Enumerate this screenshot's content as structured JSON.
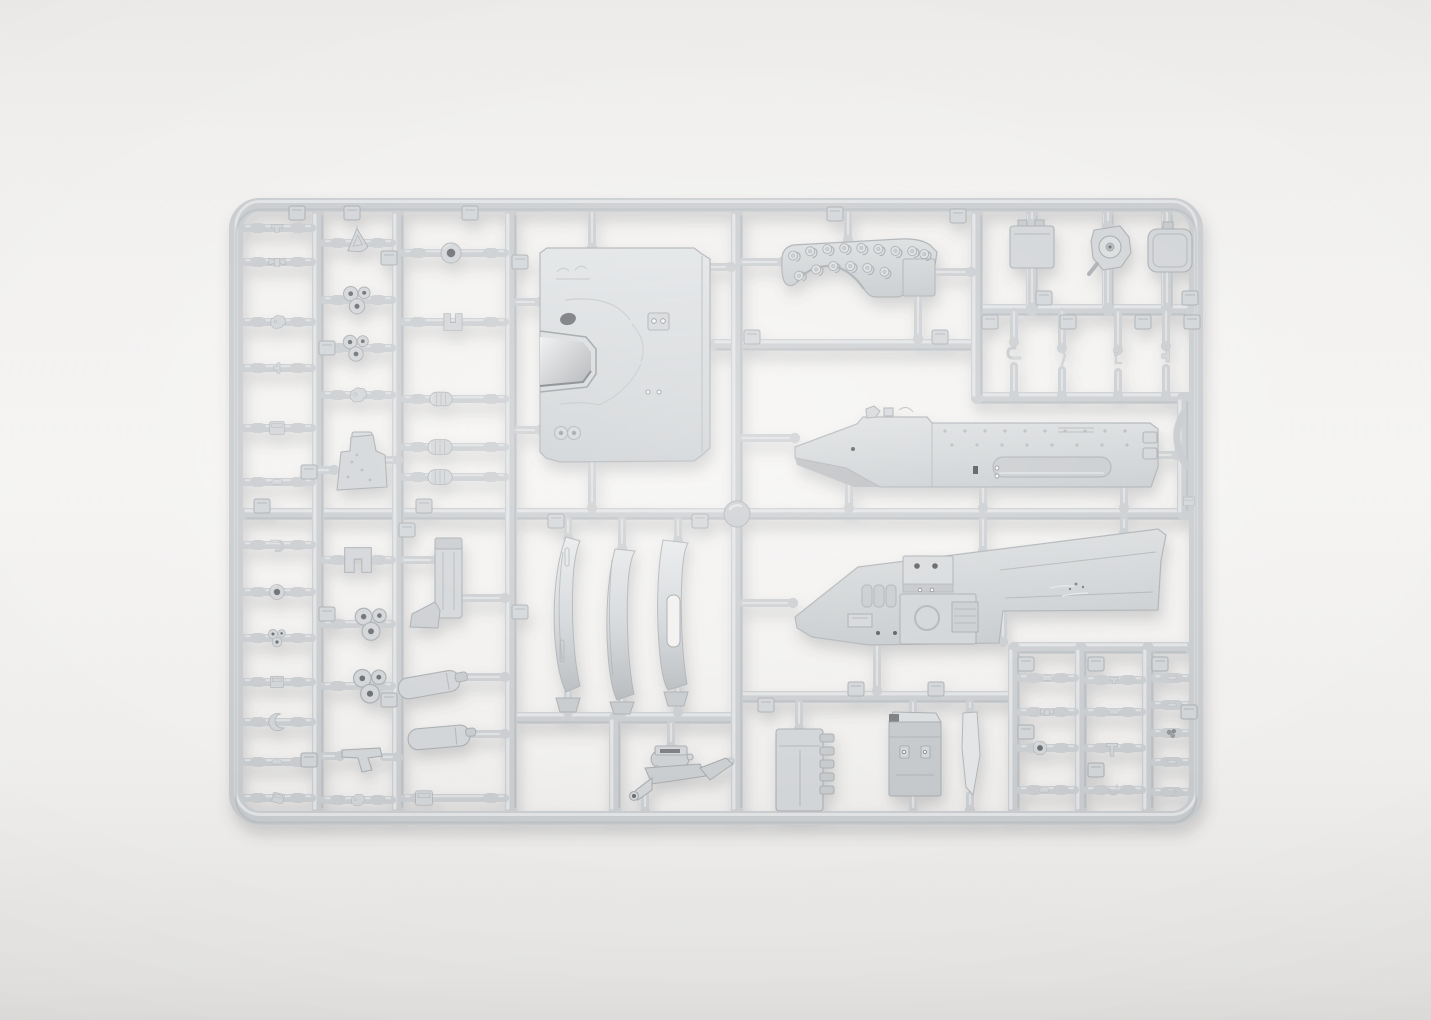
{
  "scene": {
    "description": "Photograph of a light gray injection-molded plastic model kit sprue (parts runner tree) for an armored vehicle kit, lying on a plain white studio background with a soft drop shadow",
    "object": "plastic model kit sprue",
    "material": "light gray styrene plastic",
    "background": "plain white-gray seamless backdrop",
    "colors": {
      "background_top": "#eceae8",
      "background_mid": "#f4f3f1",
      "background_bottom": "#dfdedc",
      "plastic_base": "#c5c8cb",
      "plastic_light": "#e0e2e4",
      "plastic_dark": "#a5a9ac",
      "part_fill": "#ced1d4",
      "part_stroke": "#a2a6a9",
      "panel_light": "#dee1e3",
      "panel_dark": "#c1c5c8",
      "hole_dark": "#5c5f63",
      "shadow": "#55555a"
    }
  },
  "sprue": {
    "frame": {
      "x1": 236,
      "y1": 205,
      "x2": 1196,
      "y2": 818,
      "radius": 24,
      "thickness": 14
    },
    "runners_vertical": [
      [
        318,
        212,
        811
      ],
      [
        398,
        212,
        811
      ],
      [
        511,
        212,
        811
      ],
      [
        737,
        212,
        811
      ],
      [
        977,
        212,
        398
      ],
      [
        615,
        718,
        811
      ],
      [
        1014,
        648,
        811
      ],
      [
        1081,
        648,
        811
      ],
      [
        1148,
        648,
        811
      ],
      [
        1032,
        212,
        310
      ],
      [
        1108,
        212,
        310
      ],
      [
        1167,
        212,
        310
      ],
      [
        1183,
        398,
        514
      ]
    ],
    "runners_horizontal": [
      [
        243,
        1189,
        514
      ],
      [
        713,
        977,
        345
      ],
      [
        977,
        1189,
        398
      ],
      [
        977,
        1189,
        310
      ],
      [
        511,
        737,
        718
      ],
      [
        737,
        1014,
        697
      ],
      [
        1014,
        1189,
        648
      ]
    ],
    "row_stems": [
      [
        228,
        244,
        312
      ],
      [
        262,
        244,
        312
      ],
      [
        322,
        244,
        312
      ],
      [
        368,
        244,
        312
      ],
      [
        428,
        244,
        312
      ],
      [
        482,
        244,
        312
      ],
      [
        545,
        244,
        312
      ],
      [
        592,
        244,
        312
      ],
      [
        638,
        244,
        312
      ],
      [
        682,
        244,
        312
      ],
      [
        722,
        244,
        312
      ],
      [
        762,
        244,
        312
      ],
      [
        798,
        244,
        312
      ],
      [
        243,
        324,
        392
      ],
      [
        300,
        324,
        392
      ],
      [
        348,
        324,
        392
      ],
      [
        395,
        324,
        392
      ],
      [
        560,
        324,
        392
      ],
      [
        624,
        324,
        392
      ],
      [
        686,
        324,
        392
      ],
      [
        800,
        324,
        392
      ],
      [
        253,
        404,
        505
      ],
      [
        322,
        404,
        505
      ],
      [
        399,
        404,
        505
      ],
      [
        447,
        404,
        505
      ],
      [
        477,
        404,
        505
      ],
      [
        798,
        404,
        505
      ],
      [
        678,
        1020,
        1075
      ],
      [
        712,
        1020,
        1075
      ],
      [
        748,
        1020,
        1075
      ],
      [
        790,
        1020,
        1075
      ],
      [
        680,
        1087,
        1142
      ],
      [
        712,
        1087,
        1142
      ],
      [
        748,
        1087,
        1142
      ],
      [
        790,
        1087,
        1142
      ],
      [
        678,
        1154,
        1189
      ],
      [
        705,
        1154,
        1189
      ],
      [
        733,
        1154,
        1189
      ],
      [
        762,
        1154,
        1189
      ],
      [
        792,
        1154,
        1189
      ]
    ],
    "stems": [
      [
        592,
        212,
        592,
        248
      ],
      [
        592,
        462,
        592,
        508
      ],
      [
        517,
        302,
        540,
        302
      ],
      [
        517,
        430,
        540,
        430
      ],
      [
        704,
        267,
        731,
        267
      ],
      [
        848,
        212,
        848,
        240
      ],
      [
        743,
        262,
        782,
        262
      ],
      [
        935,
        272,
        971,
        272
      ],
      [
        918,
        296,
        918,
        339
      ],
      [
        743,
        438,
        795,
        438
      ],
      [
        849,
        468,
        849,
        508
      ],
      [
        983,
        488,
        983,
        508
      ],
      [
        1124,
        486,
        1124,
        508
      ],
      [
        1156,
        455,
        1177,
        455
      ],
      [
        983,
        520,
        983,
        551
      ],
      [
        1124,
        520,
        1124,
        533
      ],
      [
        743,
        603,
        793,
        603
      ],
      [
        877,
        645,
        877,
        691
      ],
      [
        1003,
        612,
        1003,
        642
      ],
      [
        568,
        520,
        568,
        538
      ],
      [
        622,
        520,
        622,
        549
      ],
      [
        678,
        520,
        678,
        541
      ],
      [
        568,
        692,
        568,
        712
      ],
      [
        622,
        699,
        622,
        712
      ],
      [
        678,
        689,
        678,
        712
      ],
      [
        671,
        724,
        671,
        747
      ],
      [
        645,
        791,
        645,
        812
      ],
      [
        731,
        761,
        708,
        771
      ],
      [
        799,
        703,
        799,
        729
      ],
      [
        799,
        809,
        799,
        813
      ],
      [
        913,
        703,
        913,
        721
      ],
      [
        913,
        795,
        913,
        813
      ],
      [
        970,
        703,
        970,
        713
      ],
      [
        970,
        795,
        970,
        810
      ],
      [
        404,
        560,
        436,
        560
      ],
      [
        462,
        598,
        505,
        598
      ],
      [
        460,
        677,
        505,
        677
      ],
      [
        468,
        734,
        505,
        734
      ],
      [
        318,
        470,
        334,
        470
      ],
      [
        386,
        460,
        398,
        460
      ],
      [
        324,
        756,
        340,
        756
      ],
      [
        384,
        757,
        398,
        757
      ],
      [
        1032,
        212,
        1032,
        224
      ],
      [
        1032,
        268,
        1032,
        308
      ],
      [
        1108,
        212,
        1108,
        226
      ],
      [
        1108,
        270,
        1108,
        308
      ],
      [
        1167,
        212,
        1167,
        228
      ],
      [
        1167,
        272,
        1167,
        308
      ],
      [
        1014,
        312,
        1014,
        342
      ],
      [
        1014,
        366,
        1014,
        396
      ],
      [
        1062,
        312,
        1062,
        348
      ],
      [
        1062,
        370,
        1062,
        396
      ],
      [
        1118,
        312,
        1118,
        350
      ],
      [
        1118,
        372,
        1118,
        396
      ],
      [
        1166,
        312,
        1166,
        346
      ],
      [
        1166,
        368,
        1166,
        396
      ]
    ],
    "pads": [
      [
        297,
        213
      ],
      [
        352,
        213
      ],
      [
        470,
        213
      ],
      [
        835,
        214
      ],
      [
        958,
        216
      ],
      [
        327,
        348
      ],
      [
        309,
        472
      ],
      [
        327,
        614
      ],
      [
        309,
        760
      ],
      [
        389,
        258
      ],
      [
        407,
        530
      ],
      [
        389,
        700
      ],
      [
        520,
        262
      ],
      [
        520,
        612
      ],
      [
        262,
        506
      ],
      [
        424,
        506
      ],
      [
        556,
        521
      ],
      [
        700,
        521
      ],
      [
        752,
        337
      ],
      [
        940,
        337
      ],
      [
        990,
        322
      ],
      [
        1068,
        322
      ],
      [
        1143,
        322
      ],
      [
        1192,
        322
      ],
      [
        1044,
        298
      ],
      [
        1190,
        298
      ],
      [
        1026,
        664
      ],
      [
        1096,
        664
      ],
      [
        1160,
        664
      ],
      [
        1026,
        732
      ],
      [
        1096,
        770
      ],
      [
        1189,
        712
      ],
      [
        766,
        705
      ],
      [
        856,
        689
      ],
      [
        936,
        689
      ]
    ],
    "gates": [
      [
        737,
        514
      ]
    ],
    "small_parts": [
      [
        "clip",
        277,
        228,
        30,
        17,
        0
      ],
      [
        "wing",
        277,
        262,
        34,
        19,
        0
      ],
      [
        "blob",
        277,
        322,
        26,
        20,
        0
      ],
      [
        "clip",
        277,
        368,
        24,
        15,
        90
      ],
      [
        "box",
        277,
        428,
        26,
        21,
        0
      ],
      [
        "bullet",
        277,
        482,
        26,
        13,
        0
      ],
      [
        "hook",
        277,
        545,
        28,
        19,
        0
      ],
      [
        "ring",
        277,
        592,
        26,
        23,
        0
      ],
      [
        "cluster",
        277,
        638,
        30,
        23,
        0
      ],
      [
        "box",
        277,
        682,
        25,
        19,
        0
      ],
      [
        "crescent",
        277,
        722,
        25,
        23,
        0
      ],
      [
        "bullet",
        277,
        762,
        21,
        12,
        0
      ],
      [
        "box",
        278,
        798,
        27,
        16,
        12
      ],
      [
        "triangle",
        357,
        240,
        34,
        31,
        0
      ],
      [
        "cluster",
        357,
        300,
        36,
        42,
        0
      ],
      [
        "cluster",
        356,
        348,
        34,
        38,
        0
      ],
      [
        "blob",
        357,
        395,
        35,
        22,
        0
      ],
      [
        "bracket",
        358,
        560,
        42,
        38,
        0
      ],
      [
        "cluster",
        371,
        624,
        44,
        42,
        0
      ],
      [
        "cluster",
        370,
        686,
        46,
        44,
        0
      ],
      [
        "blob",
        357,
        800,
        31,
        18,
        0
      ],
      [
        "ring",
        451,
        253,
        31,
        31,
        0
      ],
      [
        "bracket",
        453,
        322,
        52,
        26,
        180
      ],
      [
        "capsule",
        441,
        399,
        78,
        25,
        0
      ],
      [
        "capsule",
        440,
        447,
        86,
        27,
        0
      ],
      [
        "capsule",
        440,
        477,
        92,
        27,
        0
      ],
      [
        "box",
        424,
        798,
        36,
        24,
        0
      ],
      [
        "hook",
        1014,
        354,
        20,
        23,
        180
      ],
      [
        "bentpin",
        1062,
        358,
        17,
        21,
        0
      ],
      [
        "lpin",
        1118,
        360,
        17,
        23,
        0
      ],
      [
        "clip",
        1166,
        356,
        19,
        17,
        90
      ],
      [
        "bullet",
        1047,
        678,
        34,
        13,
        0
      ],
      [
        "wing",
        1047,
        712,
        36,
        15,
        0
      ],
      [
        "ring",
        1040,
        748,
        21,
        21,
        0
      ],
      [
        "bullet",
        1044,
        790,
        33,
        12,
        0
      ],
      [
        "clip",
        1114,
        680,
        22,
        13,
        0
      ],
      [
        "bullet",
        1114,
        712,
        30,
        12,
        0
      ],
      [
        "tpart",
        1112,
        748,
        19,
        23,
        0
      ],
      [
        "hook",
        1114,
        790,
        25,
        15,
        90
      ],
      [
        "bullet",
        1172,
        678,
        22,
        10,
        0
      ],
      [
        "bullet",
        1172,
        705,
        22,
        10,
        0
      ],
      [
        "dark",
        1172,
        733,
        19,
        15,
        0
      ],
      [
        "bullet",
        1172,
        762,
        20,
        10,
        0
      ],
      [
        "hook",
        1172,
        792,
        20,
        13,
        0
      ],
      [
        "box",
        1189,
        501,
        18,
        16,
        0
      ]
    ],
    "arch_links": [
      [
        795,
        256,
        -15
      ],
      [
        812,
        252,
        -5
      ],
      [
        829,
        250,
        0
      ],
      [
        846,
        249,
        0
      ],
      [
        863,
        249,
        5
      ],
      [
        880,
        250,
        5
      ],
      [
        897,
        252,
        8
      ],
      [
        914,
        252,
        0
      ],
      [
        926,
        255,
        0
      ],
      [
        801,
        276,
        -20
      ],
      [
        818,
        270,
        -8
      ],
      [
        835,
        267,
        0
      ],
      [
        852,
        267,
        0
      ],
      [
        869,
        269,
        8
      ],
      [
        886,
        273,
        12
      ]
    ]
  }
}
